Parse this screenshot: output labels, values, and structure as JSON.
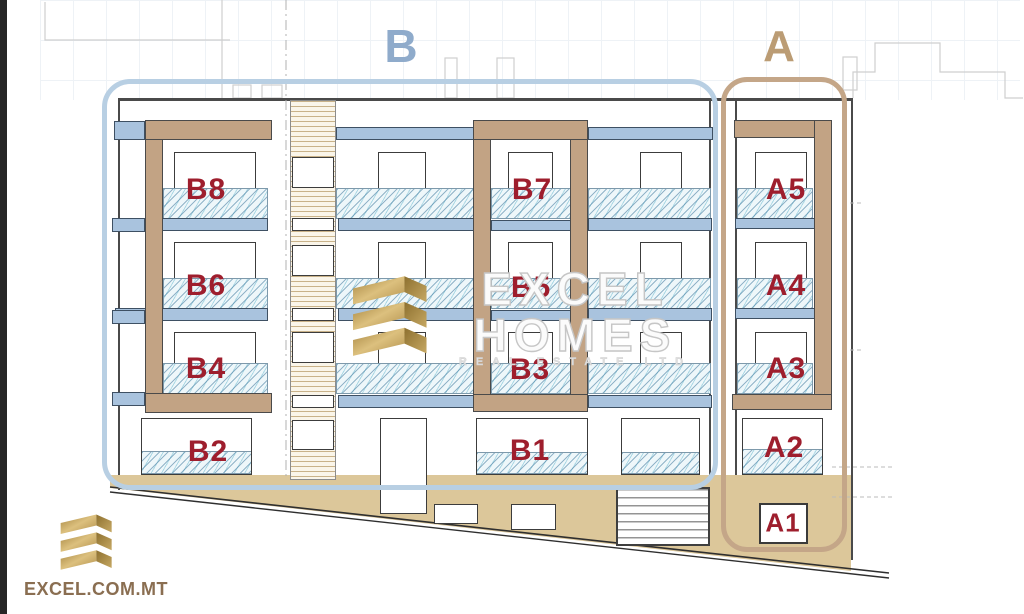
{
  "blocks": {
    "b": "B",
    "a": "A"
  },
  "units": {
    "b8": "B8",
    "b7": "B7",
    "b6": "B6",
    "b5": "B5",
    "b4": "B4",
    "b3": "B3",
    "b2": "B2",
    "b1": "B1",
    "a5": "A5",
    "a4": "A4",
    "a3": "A3",
    "a2": "A2",
    "a1": "A1"
  },
  "watermark": {
    "line1": "EXCEL",
    "line2": "HOMES",
    "line3": "REAL ESTATE LTD"
  },
  "footer": {
    "site": "EXCEL.COM.MT"
  },
  "colors": {
    "unit_label_red": "#9e1e2d",
    "block_b_blue": "#8fabcb",
    "block_a_tan": "#bb9c74",
    "slab_blue": "#a9c3de",
    "structure_tan": "#c2a384",
    "ground_tan": "#dcc79a",
    "logo_gold": "#c2a05c"
  }
}
